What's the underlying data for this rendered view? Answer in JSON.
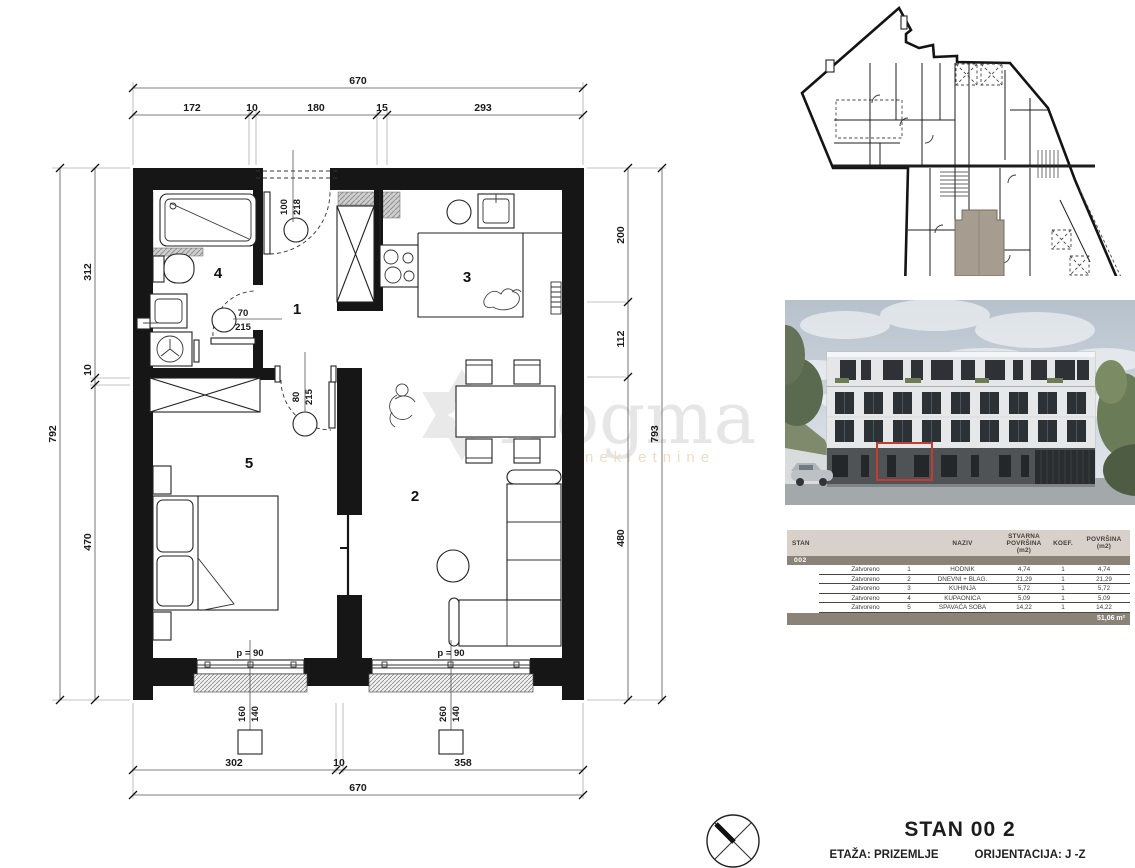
{
  "floor_plan": {
    "dim_top_total": "670",
    "dim_top_segments": [
      "172",
      "10",
      "180",
      "15",
      "293"
    ],
    "dim_bottom_total": "670",
    "dim_bottom_segments": [
      "302",
      "10",
      "358"
    ],
    "dim_left_total": "792",
    "dim_left_segments": [
      "312",
      "10",
      "470"
    ],
    "dim_right_total": "793",
    "dim_right_segments": [
      "200",
      "112",
      "480"
    ],
    "rooms": [
      {
        "number": "1"
      },
      {
        "number": "2"
      },
      {
        "number": "3"
      },
      {
        "number": "4"
      },
      {
        "number": "5"
      }
    ],
    "doors": [
      {
        "width": "100",
        "height": "218"
      },
      {
        "width": "70",
        "height": "215"
      },
      {
        "width": "80",
        "height": "215"
      }
    ],
    "windows": [
      {
        "parapet_label": "p = 90",
        "dim_a": "160",
        "dim_b": "140"
      },
      {
        "parapet_label": "p = 90",
        "dim_a": "260",
        "dim_b": "140"
      }
    ]
  },
  "watermark": {
    "brand": "Dogma",
    "tagline": "nekretnine"
  },
  "area_table": {
    "col_stan": "STAN",
    "col_naziv": "NAZIV",
    "col_stvarna_1": "STVARNA",
    "col_stvarna_2": "POVRŠINA",
    "col_stvarna_3": "(m2)",
    "col_koef": "KOEF.",
    "col_povrsina_1": "POVRŠINA",
    "col_povrsina_2": "(m2)",
    "unit_id": "002",
    "rows": [
      {
        "type": "Zatvoreno",
        "num": "1",
        "name": "HODNIK",
        "stvarna": "4,74",
        "koef": "1",
        "povrsina": "4,74"
      },
      {
        "type": "Zatvoreno",
        "num": "2",
        "name": "DNEVNI + BLAG.",
        "stvarna": "21,29",
        "koef": "1",
        "povrsina": "21,29"
      },
      {
        "type": "Zatvoreno",
        "num": "3",
        "name": "KUHINJA",
        "stvarna": "5,72",
        "koef": "1",
        "povrsina": "5,72"
      },
      {
        "type": "Zatvoreno",
        "num": "4",
        "name": "KUPAONICA",
        "stvarna": "5,09",
        "koef": "1",
        "povrsina": "5,09"
      },
      {
        "type": "Zatvoreno",
        "num": "5",
        "name": "SPAVAĆA SOBA",
        "stvarna": "14,22",
        "koef": "1",
        "povrsina": "14,22"
      }
    ],
    "total": "51,06 m²"
  },
  "footer": {
    "title": "STAN 00 2",
    "floor": "ETAŽA: PRIZEMLJE",
    "orientation": "ORIJENTACIJA: J -Z"
  }
}
